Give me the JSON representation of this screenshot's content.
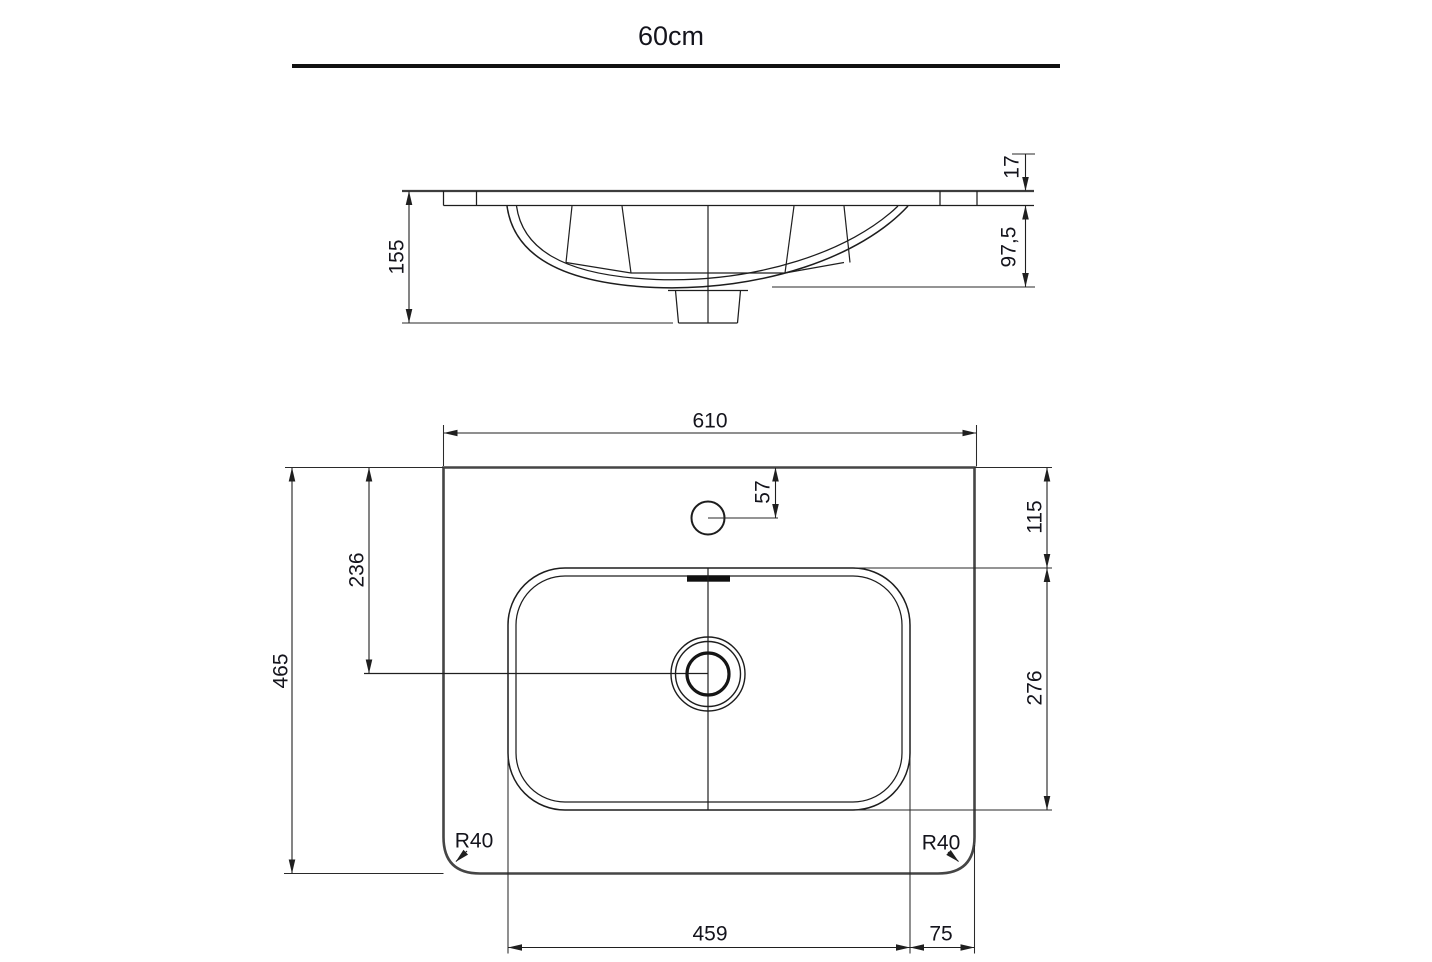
{
  "title": {
    "text": "60cm"
  },
  "colors": {
    "background": "#ffffff",
    "line": "#1f1f1f",
    "heavy_line": "#454545",
    "text": "#14141c"
  },
  "side_view": {
    "name": "side-section-view",
    "dims": {
      "total_height": "155",
      "rim_thickness": "17",
      "bowl_depth": "97,5"
    }
  },
  "top_view": {
    "name": "top-plan-view",
    "dims": {
      "total_width": "610",
      "total_depth": "465",
      "drain_center_from_back": "236",
      "faucet_center_from_back": "57",
      "bowl_offset_back": "115",
      "bowl_depth": "276",
      "bowl_width": "459",
      "bowl_to_right_edge": "75",
      "corner_radius_left": "R40",
      "corner_radius_right": "R40"
    }
  }
}
